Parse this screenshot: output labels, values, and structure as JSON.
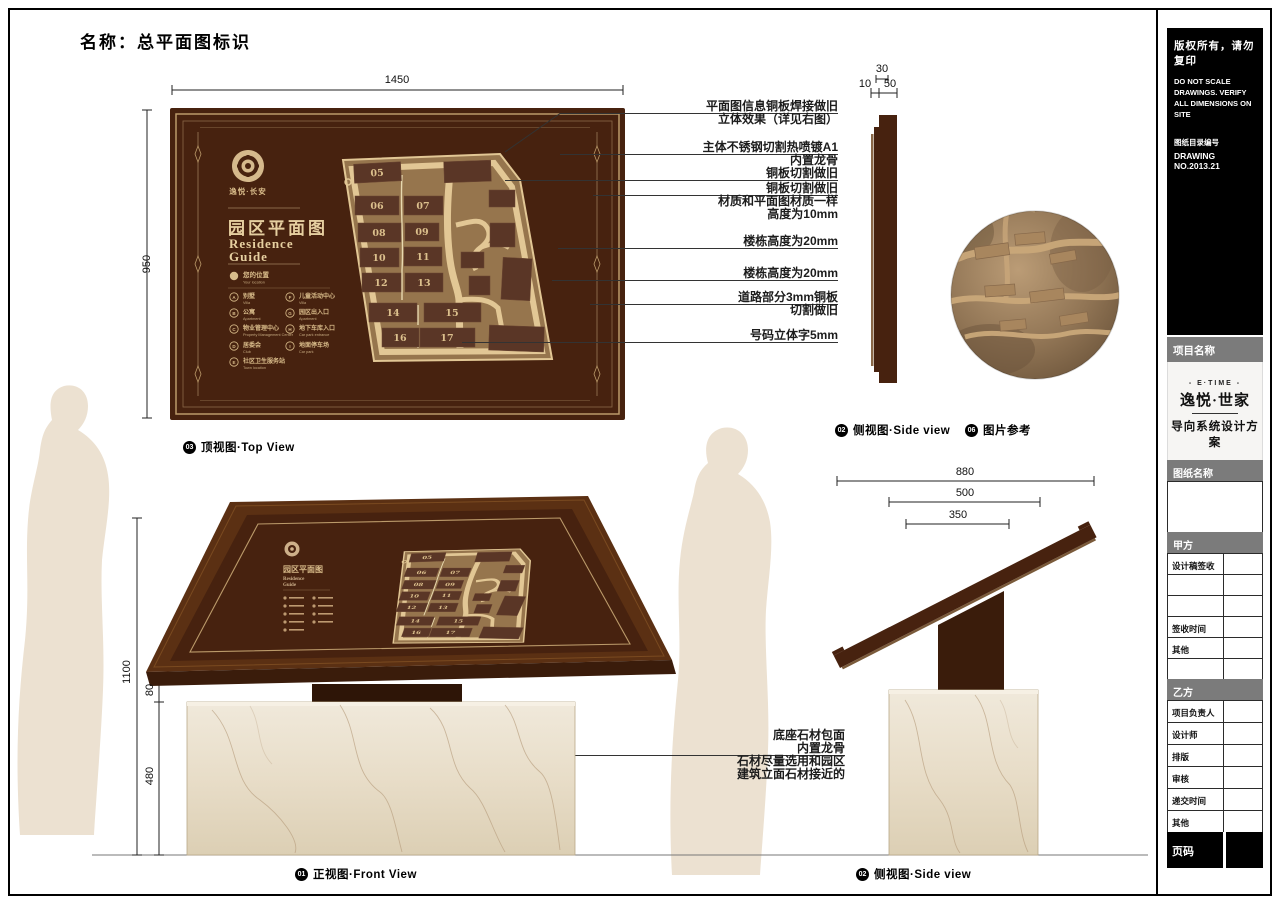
{
  "page": {
    "title": "名称：总平面图标识"
  },
  "topview": {
    "label": {
      "num": "03",
      "text": "顶视图·Top View"
    },
    "dims": {
      "width": "1450",
      "height": "950"
    },
    "panel": {
      "brand": "逸悦·长安",
      "title_cn": "园区平面图",
      "title_en_line1": "Residence",
      "title_en_line2": "Guide",
      "legend_header": {
        "cn": "您的位置",
        "en": "Your location"
      },
      "legend": [
        {
          "key": "A",
          "cn": "别墅",
          "en": "Villa"
        },
        {
          "key": "B",
          "cn": "公寓",
          "en": "Apartment"
        },
        {
          "key": "C",
          "cn": "物业管理中心",
          "en": "Property Management Center"
        },
        {
          "key": "D",
          "cn": "居委会",
          "en": "Club"
        },
        {
          "key": "E",
          "cn": "社区卫生服务站",
          "en": "Town location"
        },
        {
          "key": "F",
          "cn": "儿童活动中心",
          "en": "Villa"
        },
        {
          "key": "G",
          "cn": "园区出入口",
          "en": "Apartment"
        },
        {
          "key": "H",
          "cn": "地下车库入口",
          "en": "Car park entrance"
        },
        {
          "key": "I",
          "cn": "地面停车场",
          "en": "Car park"
        }
      ],
      "buildings": [
        "05",
        "06",
        "07",
        "08",
        "09",
        "10",
        "11",
        "12",
        "13",
        "14",
        "15",
        "16",
        "17"
      ]
    },
    "annotations": [
      {
        "lines": [
          "平面图信息铜板焊接做旧",
          "立体效果（详见右图）"
        ]
      },
      {
        "lines": [
          "主体不锈钢切割热喷镀A1",
          "内置龙骨",
          "铜板切割做旧"
        ]
      },
      {
        "lines": [
          "铜板切割做旧",
          "材质和平面图材质一样",
          "高度为10mm"
        ]
      },
      {
        "lines": [
          "楼栋高度为20mm"
        ]
      },
      {
        "lines": [
          "楼栋高度为20mm"
        ]
      },
      {
        "lines": [
          "道路部分3mm铜板",
          "切割做旧"
        ]
      },
      {
        "lines": [
          "号码立体字5mm"
        ]
      }
    ]
  },
  "sideview_top": {
    "label": {
      "num": "02",
      "text": "侧视图·Side view"
    },
    "dims": {
      "d30": "30",
      "d10": "10",
      "d50": "50"
    }
  },
  "photo": {
    "label": {
      "num": "06",
      "text": "图片参考"
    }
  },
  "frontview": {
    "label": {
      "num": "01",
      "text": "正视图·Front View"
    },
    "dims": {
      "total": "1100",
      "gap": "80",
      "base": "480"
    },
    "base_note": {
      "lines": [
        "底座石材包面",
        "内置龙骨",
        "石材尽量选用和园区",
        "建筑立面石材接近的"
      ]
    }
  },
  "sideview_bottom": {
    "label": {
      "num": "02",
      "text": "侧视图·Side view"
    },
    "dims": {
      "w1": "880",
      "w2": "500",
      "w3": "350"
    }
  },
  "sidebar": {
    "copyright_cn": "版权所有，请勿复印",
    "copyright_en": "DO NOT SCALE DRAWINGS. VERIFY ALL DIMENSIONS ON SITE",
    "index_label": "图纸目录编号",
    "drawing_no": "DRAWING NO.2013.21",
    "project_header": "项目名称",
    "logo": {
      "top": "- E·TIME -",
      "name": "逸悦·世家",
      "scheme": "导向系统设计方案"
    },
    "sheet_header": "图纸名称",
    "party_a": {
      "header": "甲方",
      "rows": [
        "设计稿签收",
        "",
        "",
        "签收时间",
        "其他",
        ""
      ]
    },
    "party_b": {
      "header": "乙方",
      "rows": [
        "项目负责人",
        "设计师",
        "排版",
        "审核",
        "递交时间",
        "其他"
      ]
    },
    "page_no": "页码"
  },
  "colors": {
    "sign_brown": "#47220f",
    "frame_tan": "#bb9a6a",
    "map_field": "#96754d",
    "map_road": "#e2c795",
    "building_brown": "#5a3626",
    "marble": "#eae2d0",
    "silhouette": "#ece1d1",
    "wood_brown": "#5b3013"
  }
}
